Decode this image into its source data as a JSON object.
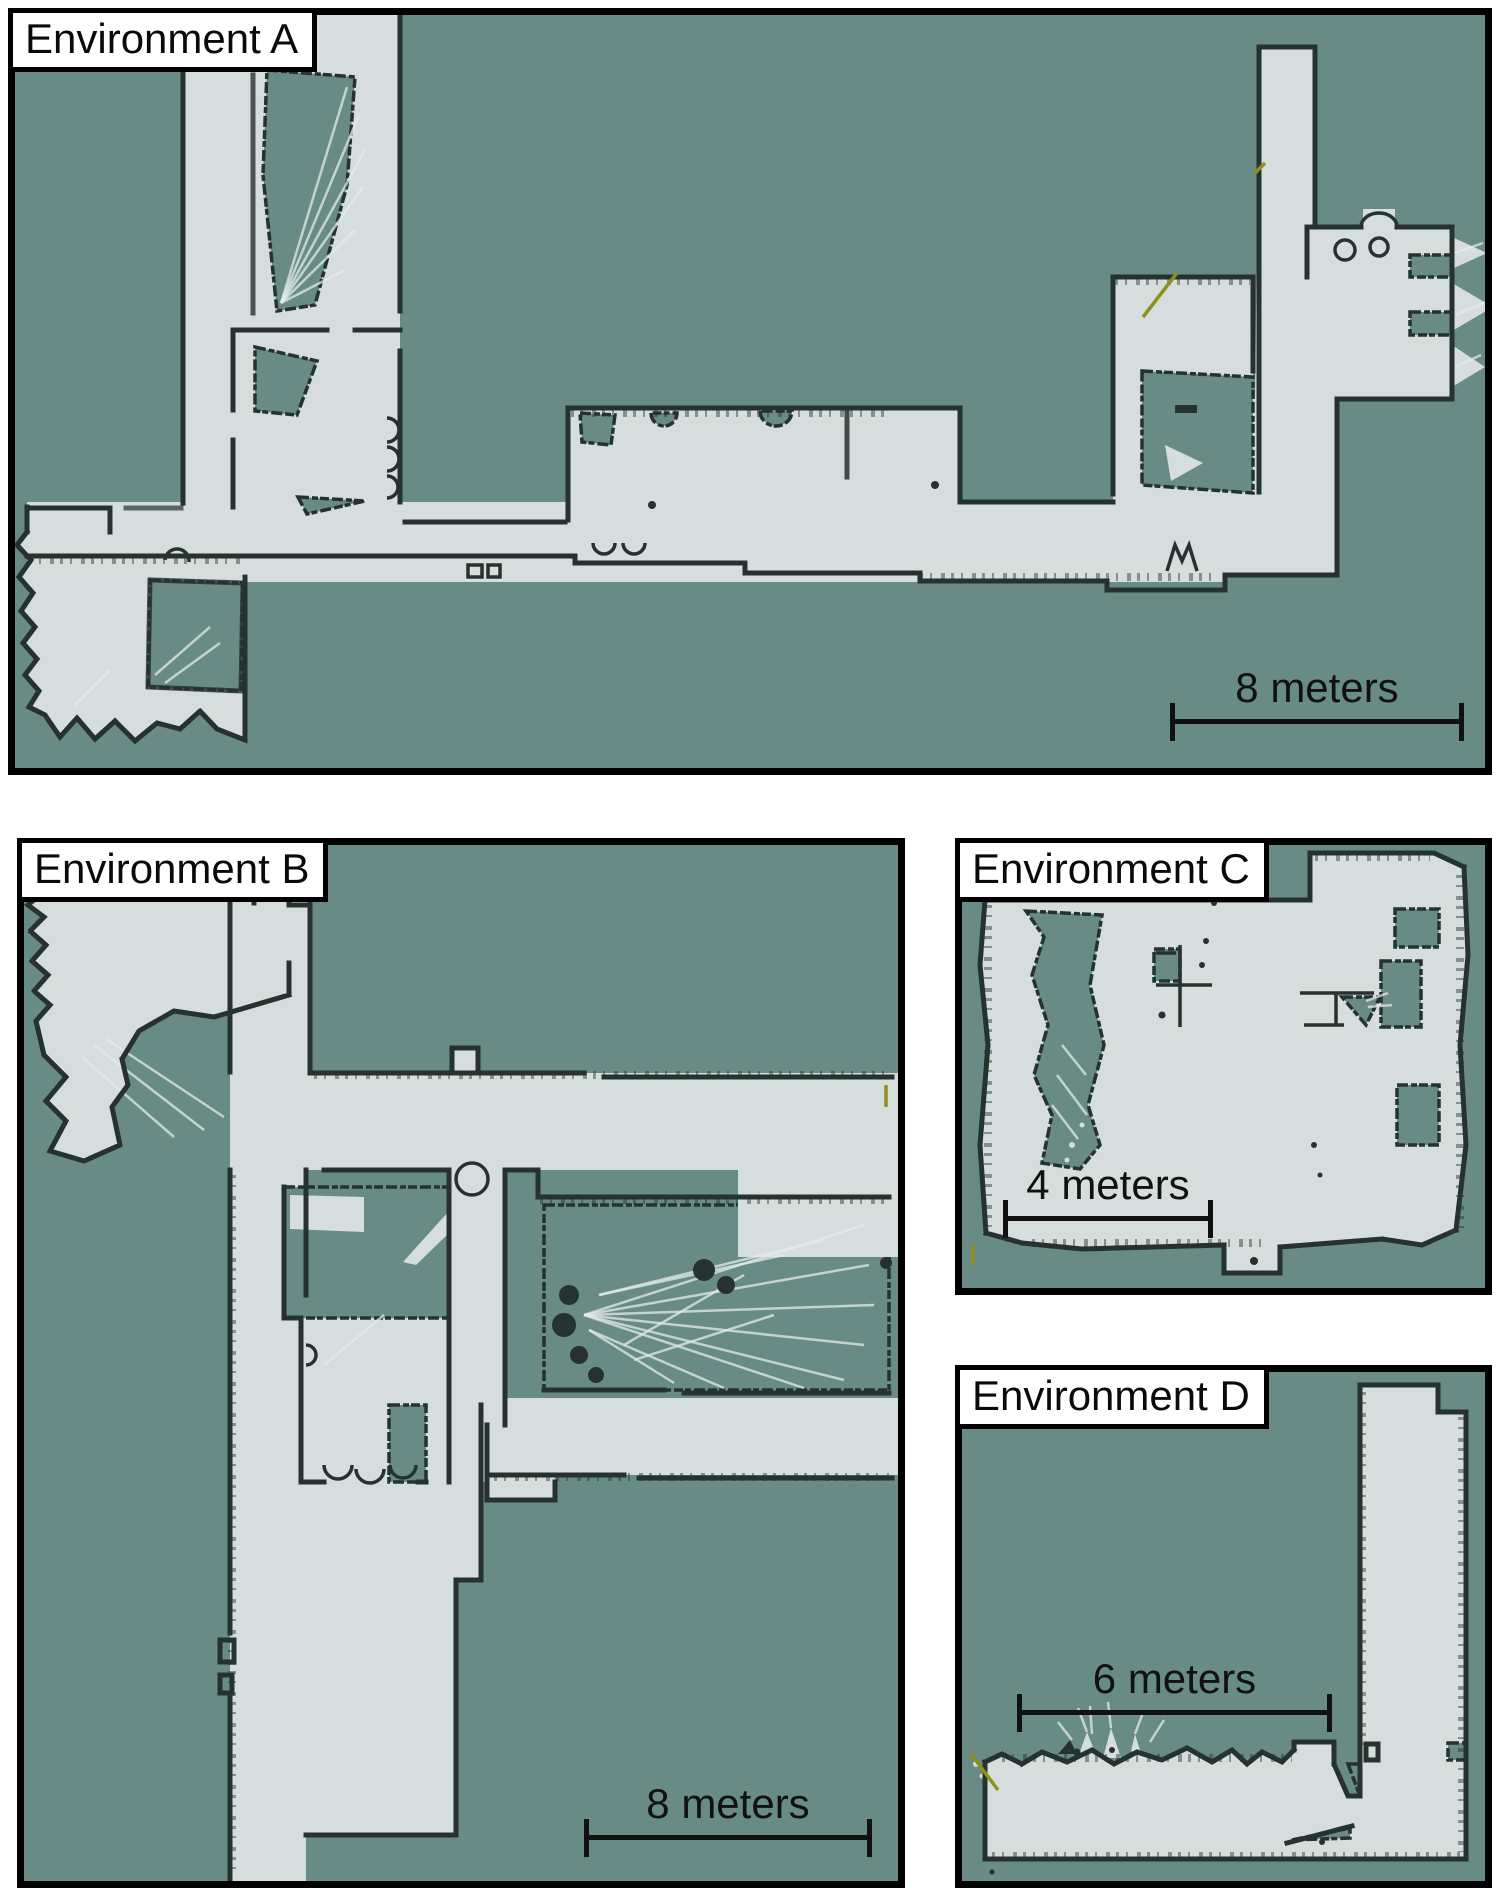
{
  "figure": {
    "description": "Four robot-built occupancy grid maps of indoor environments",
    "map_count": "4"
  },
  "panels": [
    {
      "id": "A",
      "title": "Environment A",
      "scale_label": "8 meters"
    },
    {
      "id": "B",
      "title": "Environment B",
      "scale_label": "8 meters"
    },
    {
      "id": "C",
      "title": "Environment C",
      "scale_label": "4 meters"
    },
    {
      "id": "D",
      "title": "Environment D",
      "scale_label": "6 meters"
    }
  ],
  "colors": {
    "page_background": "#ffffff",
    "unknown_space": "#688b86",
    "free_space": "#d5dedd",
    "occupied_walls": "#26322f",
    "panel_border": "#000000",
    "label_background": "#ffffff",
    "label_text": "#000000",
    "scan_accent": "#8e901e"
  }
}
